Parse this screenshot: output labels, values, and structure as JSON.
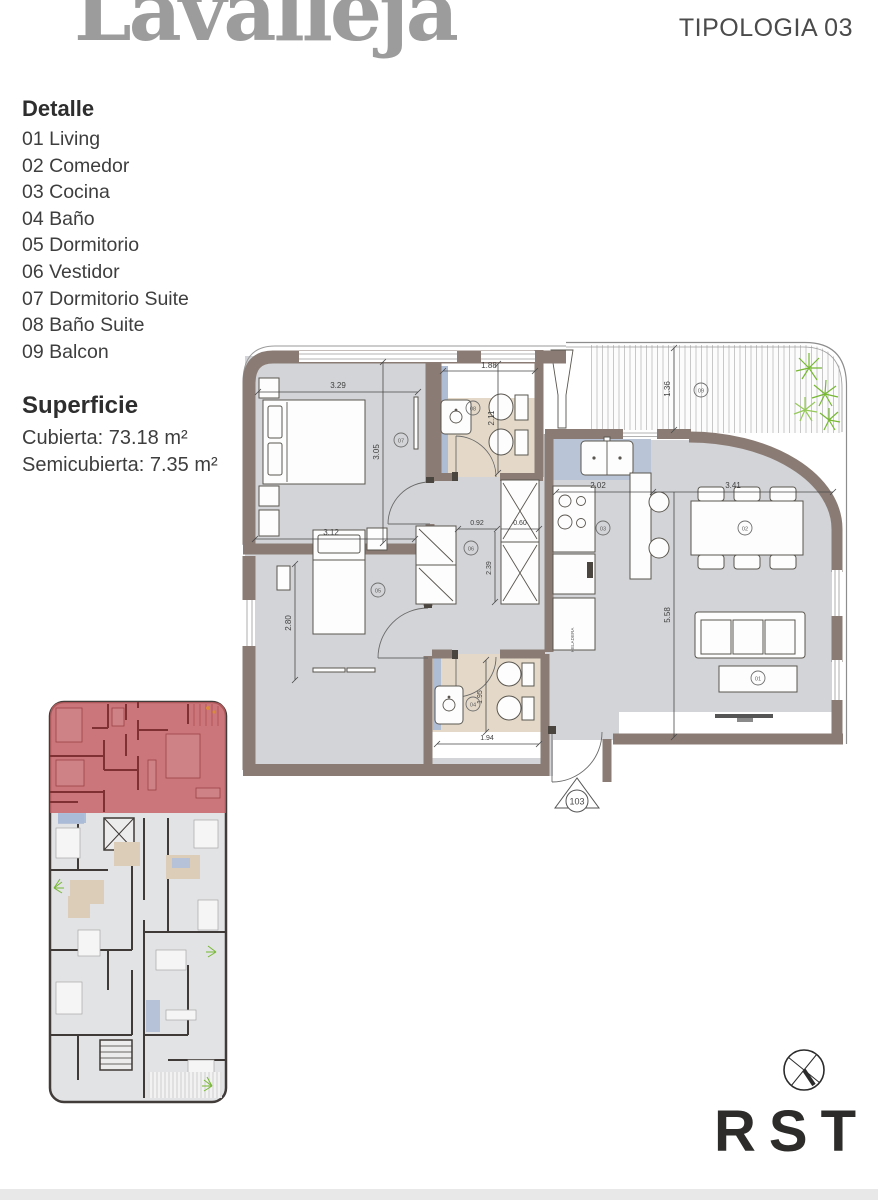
{
  "header": {
    "brand": "Lavalleja",
    "typology": "TIPOLOGIA 03"
  },
  "detalle": {
    "heading": "Detalle",
    "items": [
      "01 Living",
      "02 Comedor",
      "03 Cocina",
      "04 Baño",
      "05 Dormitorio",
      "06 Vestidor",
      "07 Dormitorio Suite",
      "08 Baño Suite",
      "09 Balcon"
    ]
  },
  "superficie": {
    "heading": "Superficie",
    "cubierta": "Cubierta: 73.18 m²",
    "semicubierta": "Semicubierta: 7.35 m²"
  },
  "plan": {
    "dims": {
      "suite_width": "3.29",
      "suite_depth": "3.05",
      "bano_suite_width": "1.88",
      "bano_suite_depth": "2.11",
      "balcon_depth": "1.36",
      "cocina_width": "2.02",
      "comedor_width": "3.41",
      "living_depth": "5.58",
      "hall_width": "0.92",
      "placard_width": "0.60",
      "vestidor_depth": "2.39",
      "dormitorio_width": "3.12",
      "dormitorio_depth": "2.80",
      "bano_width": "1.94",
      "bano_depth": "1.95"
    },
    "markers": {
      "living": "01",
      "comedor": "02",
      "cocina": "03",
      "bano": "04",
      "dormitorio": "05",
      "vestidor": "06",
      "dormitorio_suite": "07",
      "bano_suite": "08",
      "balcon": "09"
    },
    "entrance_label": "103",
    "fridge_label": "HELADERA"
  },
  "footer": {
    "logo_text": "RST"
  },
  "colors": {
    "wall": "#8a7b74",
    "floor": "#d3d4d7",
    "bath_floor": "#e4d9c9",
    "tile": "#afbdd4",
    "counter": "#b9c5d6",
    "highlight": "#c45e62",
    "brand_gray": "#9c9c9c",
    "plant_green": "#76b832",
    "ink": "#3e3e3e"
  }
}
